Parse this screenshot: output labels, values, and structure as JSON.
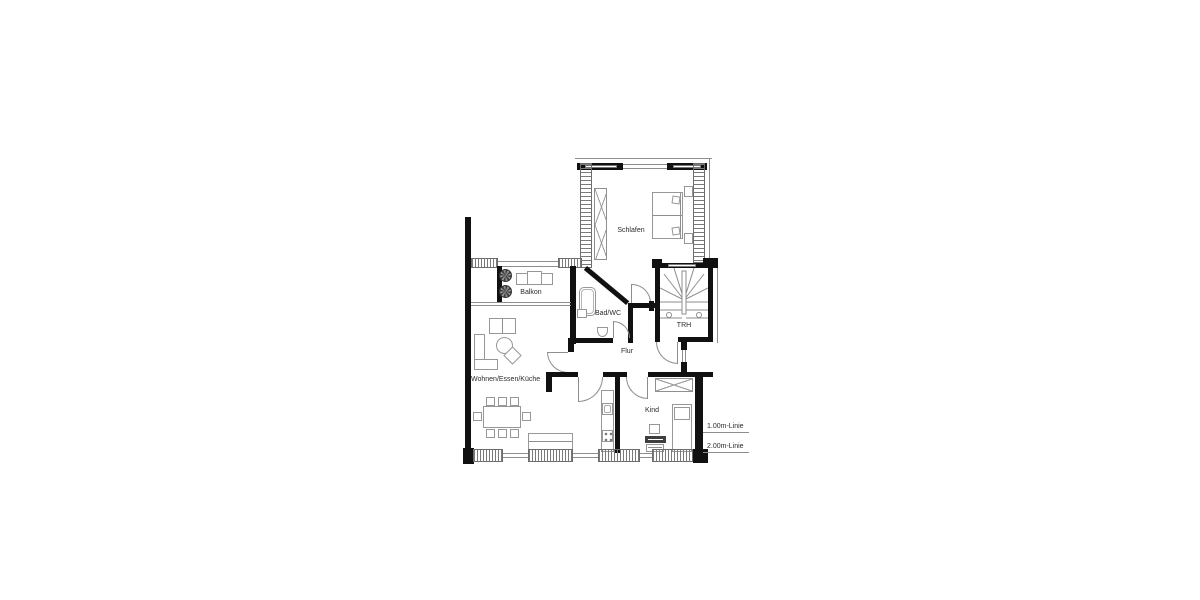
{
  "rooms": {
    "schlafen": "Schlafen",
    "balkon": "Balkon",
    "bad_wc": "Bad/WC",
    "trh": "TRH",
    "flur": "Flur",
    "wohnen_essen_kueche": "Wohnen/Essen/Küche",
    "kind": "Kind"
  },
  "annotations": {
    "line_1m": "1.00m-Linie",
    "line_2m": "2.00m-Linie"
  },
  "colors": {
    "wall": "#111111",
    "thin_line": "#8d8d8d",
    "text": "#2b2b2b",
    "background": "#ffffff"
  }
}
